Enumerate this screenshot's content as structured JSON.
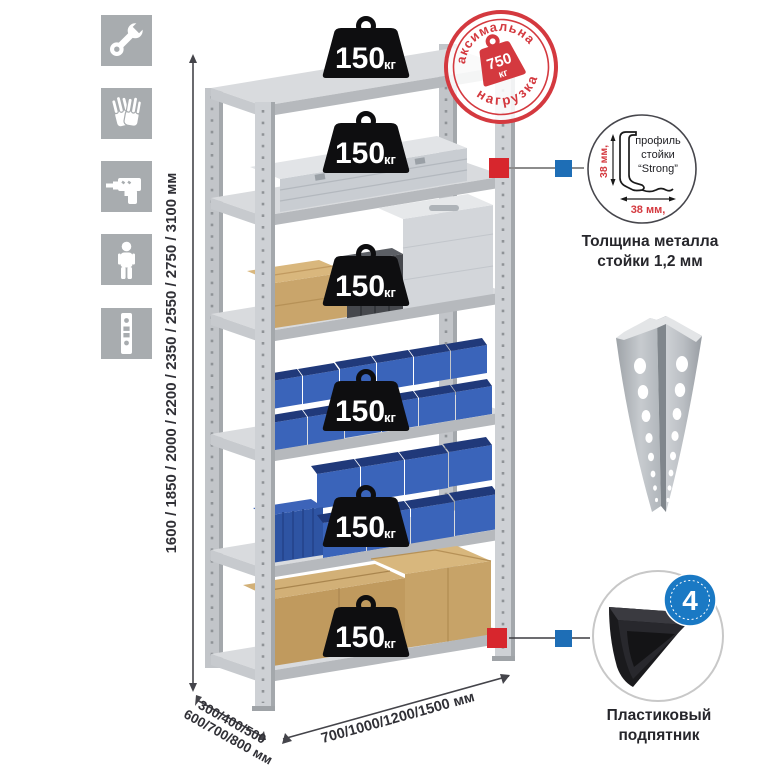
{
  "product": {
    "type": "metal shelving rack diagram"
  },
  "left_icons": {
    "background": "#a8acaf",
    "items": [
      {
        "name": "wrench-icon"
      },
      {
        "name": "gloves-icon"
      },
      {
        "name": "drill-icon"
      },
      {
        "name": "person-icon"
      },
      {
        "name": "perforated-profile-icon"
      }
    ]
  },
  "height_dimension": {
    "label": "1600 / 1850 / 2000 / 2200 / 2350 / 2550 / 2750 / 3100 мм"
  },
  "depth_dimension": {
    "line1": "300/400/500",
    "line2": "600/700/800 мм"
  },
  "width_dimension": {
    "label": "700/1000/1200/1500 мм"
  },
  "shelf_weights": {
    "value": "150",
    "unit": "кг",
    "count": 6
  },
  "max_load_stamp": {
    "top_text": "максимальная",
    "bottom_text": "нагрузка",
    "value": "750",
    "unit": "кг",
    "color": "#d4393f"
  },
  "profile_callout": {
    "label_line1": "профиль",
    "label_line2": "стойки",
    "label_line3": "“Strong”",
    "dim_vertical": "38 мм,",
    "dim_horizontal": "38 мм,",
    "caption_line1": "Толщина металла",
    "caption_line2": "стойки 1,2 мм"
  },
  "foot_callout": {
    "badge_value": "4",
    "badge_text": "в комплекте",
    "badge_color": "#1a79c4",
    "caption_line1": "Пластиковый",
    "caption_line2": "подпятник"
  },
  "markers": {
    "red": "#d7262d",
    "blue": "#1e6eb6"
  },
  "colors": {
    "metal_gray": "#c9ccd0",
    "bin_blue": "#3a64ba",
    "cardboard": "#c9a56b",
    "icon_bg": "#a8acaf"
  }
}
